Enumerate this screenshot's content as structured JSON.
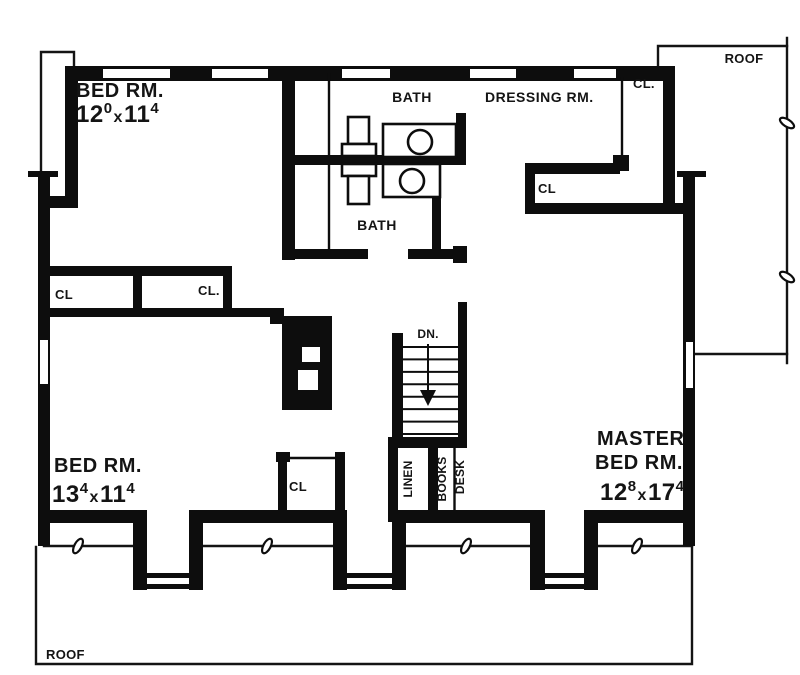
{
  "rooms": {
    "bedroom1": {
      "name": "BED RM.",
      "dim": {
        "ft1": "12",
        "in1": "0",
        "sep": "x",
        "ft2": "11",
        "in2": "4"
      }
    },
    "bedroom2": {
      "name": "BED RM.",
      "dim": {
        "ft1": "13",
        "in1": "4",
        "sep": "x",
        "ft2": "11",
        "in2": "4"
      }
    },
    "master": {
      "name_line1": "MASTER",
      "name_line2": "BED RM.",
      "dim": {
        "ft1": "12",
        "in1": "8",
        "sep": "x",
        "ft2": "17",
        "in2": "4"
      }
    },
    "bath_upper": {
      "name": "BATH"
    },
    "bath_lower": {
      "name": "BATH"
    },
    "dressing": {
      "name": "DRESSING RM."
    }
  },
  "closets": {
    "top_right": "CL.",
    "mid_right": "CL",
    "left_a": "CL",
    "left_b": "CL.",
    "bedroom2": "CL"
  },
  "stairs": {
    "label": "DN."
  },
  "builtins": {
    "linen": "LINEN",
    "books": "BOOKS",
    "desk": "DESK"
  },
  "roof": {
    "upper": "ROOF",
    "lower": "ROOF"
  },
  "colors": {
    "ink": "#0d0d0d",
    "paper": "#ffffff"
  }
}
